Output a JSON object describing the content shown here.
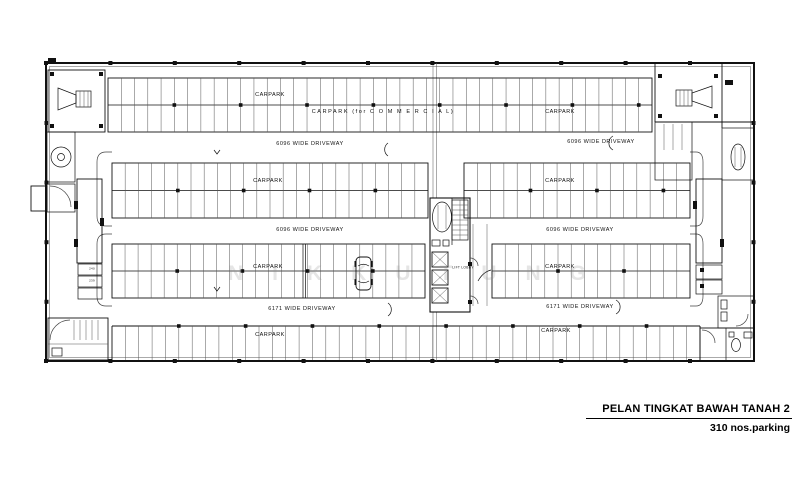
{
  "title_block": {
    "title": "PELAN  TINGKAT BAWAH TANAH 2",
    "subtitle": "310 nos.parking"
  },
  "labels": {
    "carpark": "CARPARK",
    "carpark_commercial": "CARPARK  (for C O M M E R C I A L)",
    "driveway_6096": "6096  WIDE  DRIVEWAY",
    "driveway_6171": "6171  WIDE  DRIVEWAY",
    "lift_lobby": "LIFT  LOBBY"
  },
  "stall_labels": {
    "left_stall_upper": "240",
    "left_stall_lower": "239"
  },
  "watermark": "NIKKUTUNG",
  "colors": {
    "line": "#111111",
    "background": "#ffffff",
    "watermark": "#8d8d8d"
  }
}
